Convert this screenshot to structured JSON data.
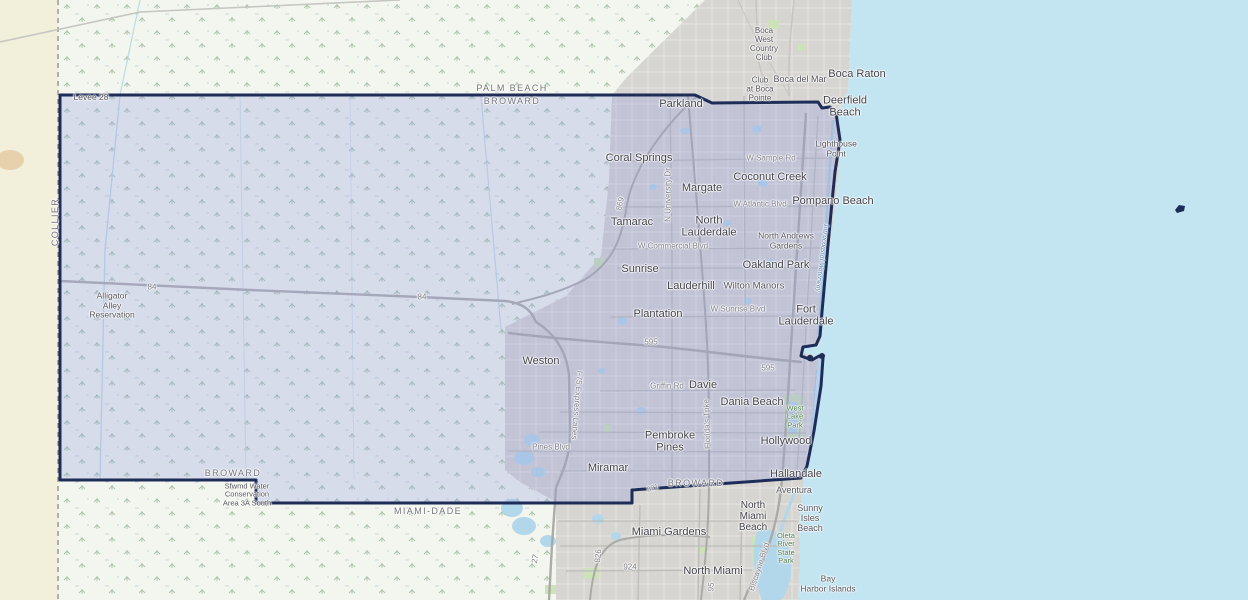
{
  "map": {
    "region_name": "Broward County, Florida",
    "colors": {
      "ocean": "#c3e5f1",
      "wetland": "#f3f6ee",
      "collier_land": "#f2f0db",
      "urban": "#d6d5d1",
      "county_fill": "rgba(148,158,224,0.30)",
      "county_border": "#1d2d57",
      "park_green": "#cde2b8",
      "lake_blue": "#b3d7ea"
    },
    "labels": {
      "cities": [
        {
          "t": "Boca Raton",
          "x": 857,
          "y": 74
        },
        {
          "t": "Parkland",
          "x": 681,
          "y": 104
        },
        {
          "t": "Deerfield\nBeach",
          "x": 845,
          "y": 107
        },
        {
          "t": "Coral Springs",
          "x": 639,
          "y": 158
        },
        {
          "t": "Margate",
          "x": 702,
          "y": 188
        },
        {
          "t": "Coconut Creek",
          "x": 770,
          "y": 177
        },
        {
          "t": "Pompano Beach",
          "x": 833,
          "y": 201
        },
        {
          "t": "Tamarac",
          "x": 632,
          "y": 222
        },
        {
          "t": "North\nLauderdale",
          "x": 709,
          "y": 227
        },
        {
          "t": "Sunrise",
          "x": 640,
          "y": 269
        },
        {
          "t": "Oakland Park",
          "x": 776,
          "y": 265
        },
        {
          "t": "Lauderhill",
          "x": 691,
          "y": 286
        },
        {
          "t": "Plantation",
          "x": 658,
          "y": 314
        },
        {
          "t": "Fort\nLauderdale",
          "x": 806,
          "y": 316
        },
        {
          "t": "Weston",
          "x": 541,
          "y": 361
        },
        {
          "t": "Davie",
          "x": 703,
          "y": 385
        },
        {
          "t": "Dania Beach",
          "x": 752,
          "y": 402
        },
        {
          "t": "Pembroke\nPines",
          "x": 670,
          "y": 442
        },
        {
          "t": "Hollywood",
          "x": 786,
          "y": 441
        },
        {
          "t": "Miramar",
          "x": 608,
          "y": 468
        },
        {
          "t": "Hallandale",
          "x": 796,
          "y": 474
        },
        {
          "t": "Miami Gardens",
          "x": 669,
          "y": 532
        },
        {
          "t": "North Miami",
          "x": 713,
          "y": 571
        },
        {
          "t": "North\nMiami\nBeach",
          "x": 753,
          "y": 517,
          "s": 10
        }
      ],
      "places": [
        {
          "t": "Boca\nWest\nCountry\nClub",
          "x": 764,
          "y": 45,
          "s": 8
        },
        {
          "t": "Boca del Mar",
          "x": 800,
          "y": 79,
          "s": 9
        },
        {
          "t": "Club\nat Boca\nPointe",
          "x": 760,
          "y": 90,
          "s": 8
        },
        {
          "t": "Lighthouse\nPoint",
          "x": 836,
          "y": 149
        },
        {
          "t": "North Andrews\nGardens",
          "x": 786,
          "y": 241
        },
        {
          "t": "Wilton Manors",
          "x": 754,
          "y": 287,
          "s": 9.5
        },
        {
          "t": "Aventura",
          "x": 794,
          "y": 490,
          "s": 9
        },
        {
          "t": "Sunny\nIsles\nBeach",
          "x": 810,
          "y": 518,
          "s": 9
        },
        {
          "t": "Bay\nHarbor Islands",
          "x": 828,
          "y": 584
        },
        {
          "t": "Levee 28",
          "x": 91,
          "y": 98
        },
        {
          "t": "Alligator\nAlley\nReservation",
          "x": 112,
          "y": 306
        },
        {
          "t": "Sfwmd Water\nConservation\nArea 3A South",
          "x": 247,
          "y": 495,
          "s": 7.5
        }
      ],
      "parks": [
        {
          "t": "West\nLake\nPark",
          "x": 795,
          "y": 417
        },
        {
          "t": "Oleta\nRiver\nState\nPark",
          "x": 786,
          "y": 549
        }
      ],
      "water": [
        {
          "t": "Intracoastal Waterway",
          "x": 822,
          "y": 258,
          "r": 97
        }
      ],
      "counties": [
        {
          "t": "PALM BEACH",
          "x": 512,
          "y": 88
        },
        {
          "t": "BROWARD",
          "x": 512,
          "y": 101
        },
        {
          "t": "COLLIER",
          "x": 55,
          "y": 222,
          "r": -90
        },
        {
          "t": "BROWARD",
          "x": 233,
          "y": 473
        },
        {
          "t": "MIAMI-DADE",
          "x": 428,
          "y": 511
        },
        {
          "t": "BROWARD",
          "x": 696,
          "y": 483
        }
      ],
      "roads": [
        {
          "t": "W Sample Rd",
          "x": 771,
          "y": 159
        },
        {
          "t": "W Atlantic Blvd",
          "x": 760,
          "y": 205
        },
        {
          "t": "W Commercial Blvd",
          "x": 673,
          "y": 247
        },
        {
          "t": "W Sunrise Blvd",
          "x": 738,
          "y": 310
        },
        {
          "t": "Griffin Rd",
          "x": 667,
          "y": 387
        },
        {
          "t": "Pines Blvd",
          "x": 551,
          "y": 448
        },
        {
          "t": "N University Dr",
          "x": 669,
          "y": 195,
          "r": -90
        },
        {
          "t": "I-75 Express Lanes",
          "x": 576,
          "y": 405,
          "r": 95
        },
        {
          "t": "Florida's Tpke",
          "x": 708,
          "y": 424,
          "r": -92
        },
        {
          "t": "Biscayne Blvd",
          "x": 760,
          "y": 567,
          "r": -72
        },
        {
          "t": "84",
          "x": 152,
          "y": 288
        },
        {
          "t": "84",
          "x": 422,
          "y": 298
        },
        {
          "t": "869",
          "x": 621,
          "y": 204,
          "r": -78
        },
        {
          "t": "595",
          "x": 651,
          "y": 343
        },
        {
          "t": "595",
          "x": 768,
          "y": 369
        },
        {
          "t": "821",
          "x": 653,
          "y": 489,
          "r": -18,
          "s": 7
        },
        {
          "t": "826",
          "x": 599,
          "y": 556,
          "r": -85
        },
        {
          "t": "924",
          "x": 630,
          "y": 568
        },
        {
          "t": "27",
          "x": 536,
          "y": 559,
          "r": -80
        },
        {
          "t": "95",
          "x": 712,
          "y": 587,
          "r": -85
        }
      ]
    }
  }
}
